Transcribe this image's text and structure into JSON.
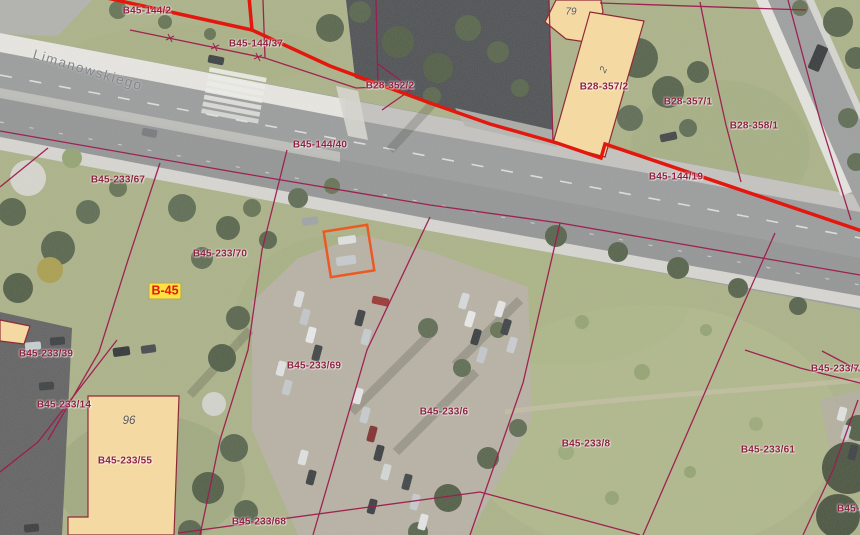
{
  "map": {
    "street_label": "Limanowskiego",
    "area_label": {
      "text": "B-45"
    },
    "building_numbers": [
      {
        "text": "79"
      },
      {
        "text": "2"
      },
      {
        "text": "96"
      }
    ],
    "parcel_labels": [
      {
        "text": "B45-144/2"
      },
      {
        "text": "B45-144/37"
      },
      {
        "text": "B28-352/2"
      },
      {
        "text": "B28-357/2"
      },
      {
        "text": "B28-357/1"
      },
      {
        "text": "B28-358/1"
      },
      {
        "text": "B45-144/40"
      },
      {
        "text": "B45-144/19"
      },
      {
        "text": "B45-233/67"
      },
      {
        "text": "B45-233/70"
      },
      {
        "text": "B45-233/39"
      },
      {
        "text": "B45-233/14"
      },
      {
        "text": "B45-233/55"
      },
      {
        "text": "B45-233/69"
      },
      {
        "text": "B45-233/6"
      },
      {
        "text": "B45-233/8"
      },
      {
        "text": "B45-233/61"
      },
      {
        "text": "B45-233/72"
      },
      {
        "text": "B45-233/68"
      },
      {
        "text": "B45-2"
      }
    ],
    "colors": {
      "selection_outline_red": "#e3170d",
      "parcel_boundary_magenta": "#9e1c4e",
      "parcel_label_text": "#8e2240",
      "building_fill": "#f5d9a2",
      "building_outline": "#8e2a38",
      "highlight_rectangle_orange": "#ec5a24",
      "street_label_gray": "#84878a",
      "area_label_background": "#ffe23d",
      "area_label_text": "#e3170d"
    }
  }
}
